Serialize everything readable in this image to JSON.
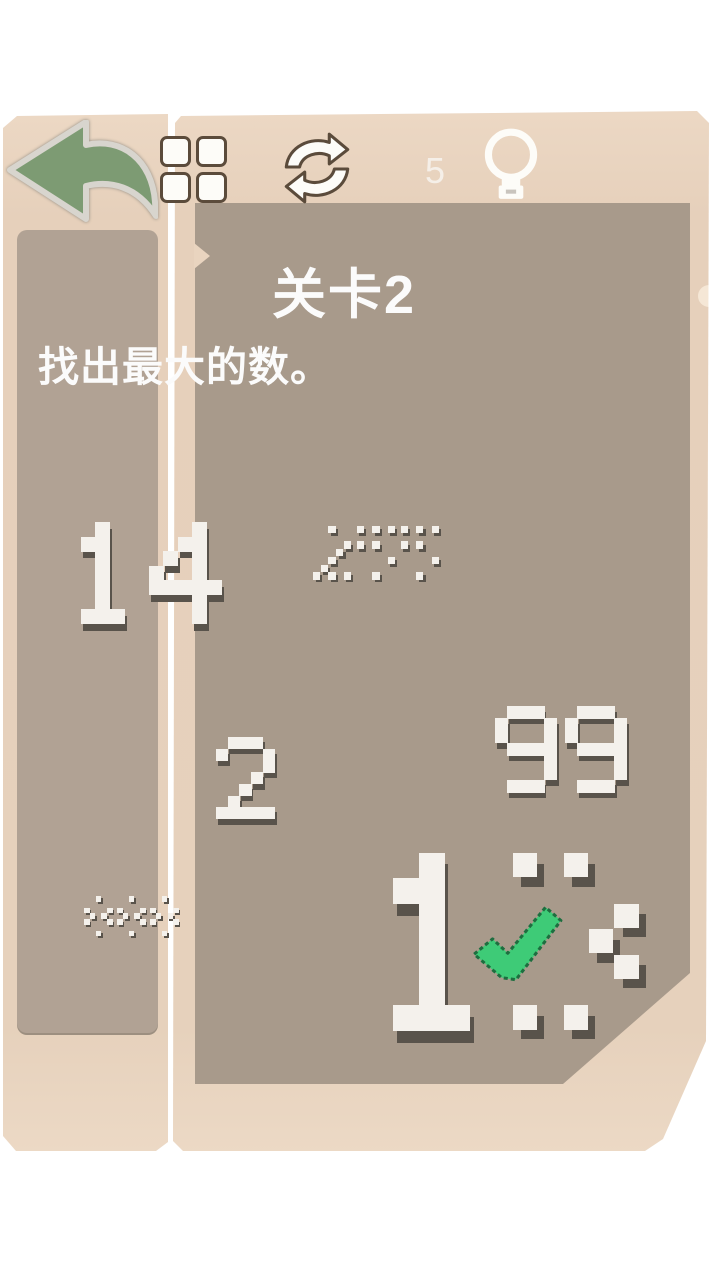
{
  "colors": {
    "panel_beige": "#e6d0bb",
    "panel_border_gray": "#8d8984",
    "inner_main": "#a89a8b",
    "inner_sidebar": "#b1a294",
    "digit_white": "#f4f1ec",
    "digit_shadow": "#59534b",
    "arrow_green": "#7d9b73",
    "arrow_outline": "#d8d5ce",
    "icon_outline": "#5b4b3b",
    "icon_white": "#fdfcf8",
    "check_green": "#3ecb77",
    "check_border": "#1d6e3f",
    "text_white": "#fbfbfb"
  },
  "toolbar": {
    "back_icon": "back-arrow-icon",
    "grid_icon": "grid-menu-icon",
    "refresh_icon": "refresh-icon",
    "hint_count": "5",
    "hint_icon": "lightbulb-icon"
  },
  "level": {
    "title": "关卡2",
    "instruction": "找出最大的数。"
  },
  "numbers": [
    {
      "value": "14",
      "style": "solid",
      "x": 66,
      "y": 522,
      "block": 14.5
    },
    {
      "value": "255",
      "style": "dithered",
      "x": 313,
      "y": 526,
      "block": 7.7
    },
    {
      "value": "2",
      "style": "solid",
      "x": 216,
      "y": 737,
      "block": 11.7
    },
    {
      "value": "99",
      "style": "solid",
      "x": 495,
      "y": 706,
      "block": 12.3
    },
    {
      "value": "888",
      "style": "dithered",
      "x": 84,
      "y": 896,
      "block": 5.8
    },
    {
      "value": "13",
      "style": "solid",
      "digit_styles": [
        "solid",
        "dithered"
      ],
      "x": 368,
      "y": 853,
      "block": 25.4,
      "selected": true
    }
  ],
  "checkmark": {
    "on": "13"
  }
}
